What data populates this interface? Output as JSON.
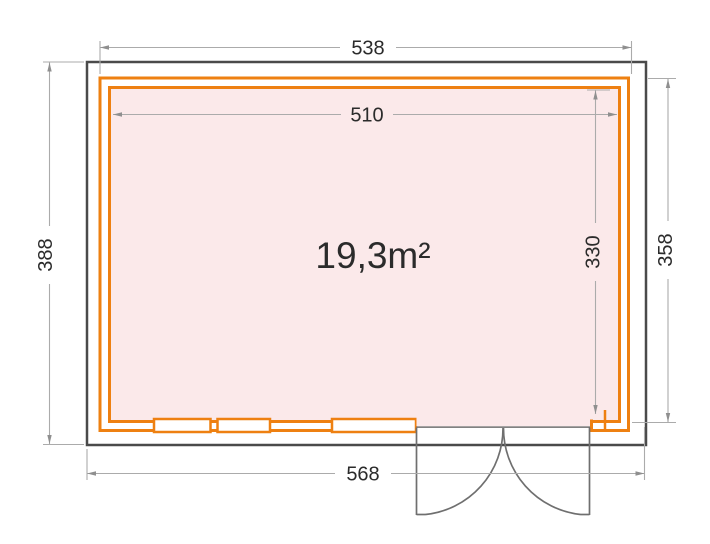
{
  "floorplan": {
    "area_label": "19,3m²",
    "dimensions": {
      "top_outer": "538",
      "top_inner": "510",
      "bottom_outer": "568",
      "left_outer": "388",
      "right_outer": "358",
      "right_inner": "330"
    }
  },
  "colors": {
    "wall_outline": "#4a4a4a",
    "timber_wall": "#ee8011",
    "floor_fill": "#fbe9ea",
    "dimension_line": "#ababab",
    "dimension_arrow": "#8f8f8f",
    "dimension_text": "#2b2b2b",
    "door_line": "#6f6f6f"
  }
}
